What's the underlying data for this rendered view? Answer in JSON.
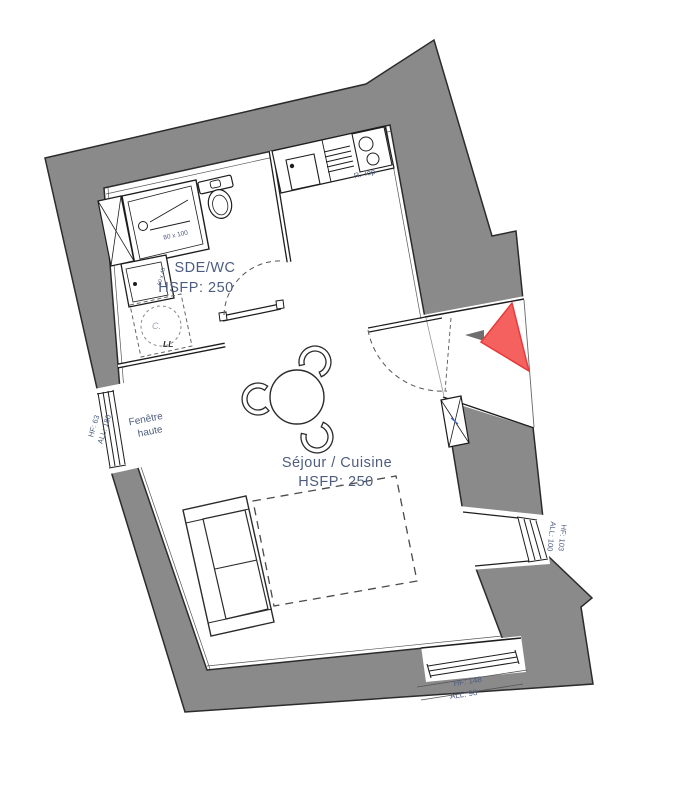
{
  "plan": {
    "rooms": [
      {
        "name": "SDE/WC",
        "hsfp": "HSFP: 250"
      },
      {
        "name": "Séjour / Cuisine",
        "hsfp": "HSFP: 250"
      }
    ],
    "windows": {
      "left": {
        "line1": "Fenêtre",
        "line2": "haute",
        "hf": "HF: 63",
        "all": "ALL: 180"
      },
      "right": {
        "hf": "HF: 103",
        "all": "ALL: 100"
      },
      "bottom": {
        "hf": "HF: 148",
        "all": "ALL: 98"
      }
    },
    "fixtures": {
      "shower_size": "80 x 100",
      "basin_size": "60 x 45",
      "hob": "R. Top",
      "boiler": "C.",
      "washer": "LL"
    },
    "colors": {
      "wall": "#8a8a8a",
      "label": "#4e5d7f",
      "red": "#f4615e",
      "red_border": "#e63a3a"
    }
  }
}
